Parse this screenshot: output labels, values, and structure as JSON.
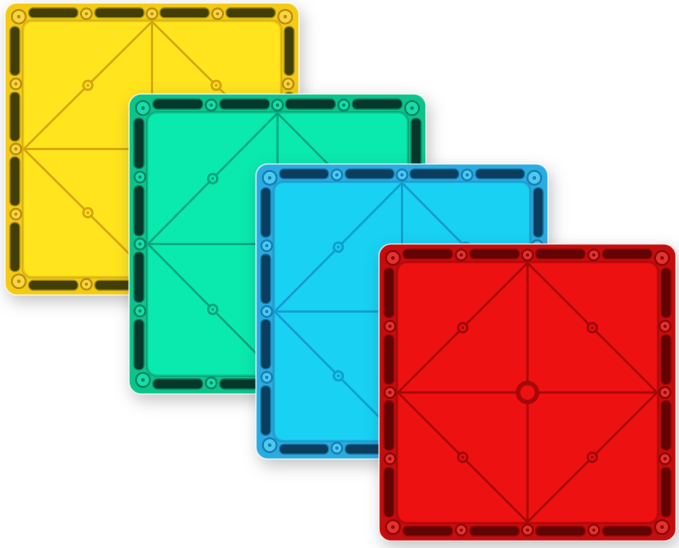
{
  "scene": {
    "background": "#ffffff",
    "width": 679,
    "height": 548,
    "description": "Four overlapping square translucent magnetic building base plates (yellow, green, blue, red) arranged diagonally on a white background"
  },
  "tiles": [
    {
      "name": "tile-yellow",
      "label": "yellow magnetic base plate",
      "x": 4,
      "y": 2,
      "w": 296,
      "h": 294,
      "z": 1,
      "colors": {
        "face": "#FFE41E",
        "frame": "#F3CB15",
        "slot": "#433D08",
        "slot_rim": "#9A8812",
        "line": "#D7A60F",
        "rivet_ring": "#BD8F0C",
        "rivet_fill": "#F8D544"
      }
    },
    {
      "name": "tile-green",
      "label": "green magnetic base plate",
      "x": 128,
      "y": 93,
      "w": 299,
      "h": 302,
      "z": 2,
      "colors": {
        "face": "#0AE9AE",
        "frame": "#0DC38C",
        "slot": "#05382B",
        "slot_rim": "#0B7F5F",
        "line": "#0AA67C",
        "rivet_ring": "#088B67",
        "rivet_fill": "#19DCA8"
      }
    },
    {
      "name": "tile-blue",
      "label": "blue magnetic base plate",
      "x": 255,
      "y": 163,
      "w": 294,
      "h": 297,
      "z": 3,
      "colors": {
        "face": "#18D1F3",
        "frame": "#2AACE0",
        "slot": "#0A3D5E",
        "slot_rim": "#1878A8",
        "line": "#0F9ED0",
        "rivet_ring": "#1480B5",
        "rivet_fill": "#4FC9F0"
      }
    },
    {
      "name": "tile-red",
      "label": "red magnetic base plate",
      "x": 378,
      "y": 243,
      "w": 299,
      "h": 299,
      "z": 4,
      "colors": {
        "face": "#EE1111",
        "frame": "#C60D0D",
        "slot": "#630404",
        "slot_rim": "#9B0808",
        "line": "#A50808",
        "rivet_ring": "#8F0707",
        "rivet_fill": "#E23333"
      }
    }
  ]
}
